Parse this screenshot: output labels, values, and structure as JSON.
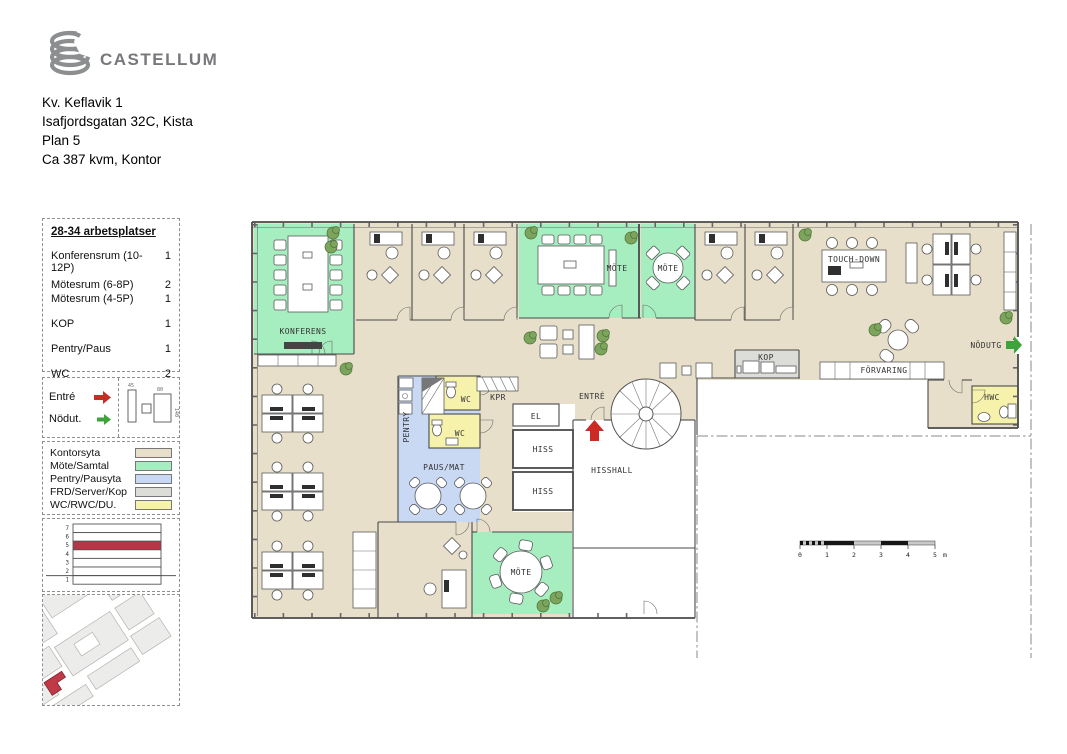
{
  "header": {
    "brand": "CASTELLUM",
    "address_lines": [
      "Kv. Keflavik 1",
      "Isafjordsgatan 32C, Kista",
      "Plan 5",
      "Ca 387 kvm, Kontor"
    ]
  },
  "summary": {
    "title": "28-34 arbetsplatser",
    "rows": [
      {
        "label": "Konferensrum (10-12P)",
        "value": "1"
      },
      {
        "label": "Mötesrum (6-8P)",
        "value": "2"
      },
      {
        "label": "Mötesrum (4-5P)",
        "value": "1"
      },
      {
        "label": "KOP",
        "value": "1"
      },
      {
        "label": "Pentry/Paus",
        "value": "1"
      },
      {
        "label": "WC",
        "value": "2"
      },
      {
        "label": "HWC",
        "value": "1"
      }
    ]
  },
  "access": {
    "entry_label": "Entré",
    "exit_label": "Nödut.",
    "dims": [
      "45",
      "80",
      "140"
    ]
  },
  "legend": {
    "items": [
      {
        "label": "Kontorsyta",
        "color": "#e7dfca"
      },
      {
        "label": "Möte/Samtal",
        "color": "#a6edc0"
      },
      {
        "label": "Pentry/Pausyta",
        "color": "#c9d9f4"
      },
      {
        "label": "FRD/Server/Kop",
        "color": "#dcdcd9"
      },
      {
        "label": "WC/RWC/DU.",
        "color": "#f6f2ab"
      }
    ]
  },
  "floors": {
    "labels": [
      "7",
      "6",
      "5",
      "4",
      "3",
      "2",
      "1"
    ],
    "highlight": "5"
  },
  "plan": {
    "labels": {
      "konferens": "KONFERENS",
      "mote_a": "MÖTE",
      "mote_b": "MÖTE",
      "mote_c": "MÖTE",
      "touchdown": "TOUCH-DOWN",
      "kop": "KOP",
      "forvaring": "FÖRVARING",
      "nodutg": "NÖDUTG",
      "hwc": "HWC",
      "wc_a": "WC",
      "wc_b": "WC",
      "kpr": "KPR",
      "pentry": "PENTRY",
      "paus": "PAUS/MAT",
      "entre": "ENTRÉ",
      "el": "EL",
      "hiss_a": "HISS",
      "hiss_b": "HISS",
      "hisshall": "HISSHALL"
    },
    "scalebar": {
      "ticks": [
        "0",
        "1",
        "2",
        "3",
        "4",
        "5"
      ],
      "unit": "m"
    }
  },
  "colors": {
    "office": "#e7dfca",
    "meeting": "#a6edc0",
    "pentry": "#c9d9f4",
    "kop": "#dcdcd9",
    "wc": "#f6f2ab",
    "entry_arrow": "#cc2a24",
    "exit_arrow": "#3fa33c",
    "floor_highlight": "#b23845",
    "map_highlight": "#bf3a46",
    "brand_grey": "#8d8e90"
  }
}
